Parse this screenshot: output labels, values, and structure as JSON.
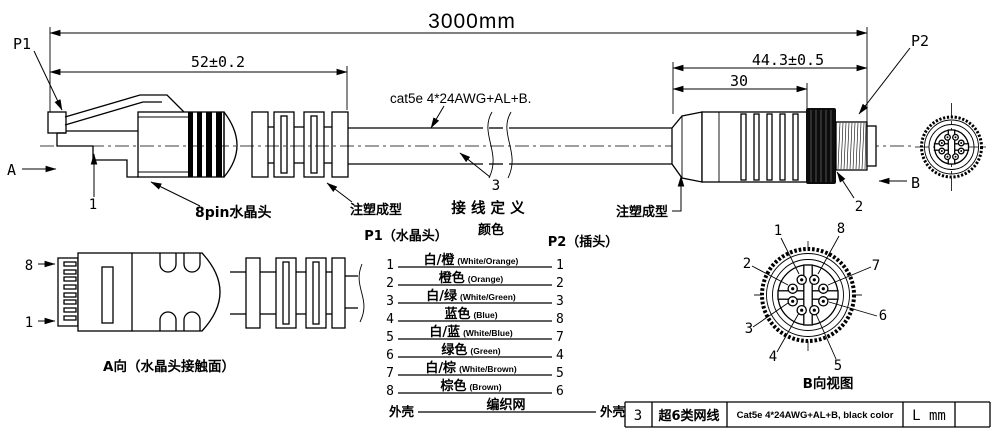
{
  "drawing": {
    "dims": {
      "overall": "3000mm",
      "len52": "52±0.2",
      "len443": "44.3±0.5",
      "len30": "30"
    },
    "ports": {
      "p1": "P1",
      "p2": "P2"
    },
    "views": {
      "a_arrow": "A",
      "b_arrow": "B"
    },
    "callouts": {
      "n1": "1",
      "n2": "2",
      "n3": "3",
      "rj45_label": "8pin水晶头",
      "mold_left": "注塑成型",
      "mold_right": "注塑成型",
      "cable_spec": "cat5e 4*24AWG+AL+B."
    },
    "wiring": {
      "title": "接 线 定 义",
      "col_p1": "P1（水晶头）",
      "col_color": "颜色",
      "col_p2": "P2（插头）",
      "rows": [
        {
          "p1": "1",
          "color": "白/橙",
          "color_en": "(White/Orange)",
          "p2": "1"
        },
        {
          "p1": "2",
          "color": "橙色",
          "color_en": "(Orange)",
          "p2": "2"
        },
        {
          "p1": "3",
          "color": "白/绿",
          "color_en": "(White/Green)",
          "p2": "3"
        },
        {
          "p1": "4",
          "color": "蓝色",
          "color_en": "(Blue)",
          "p2": "8"
        },
        {
          "p1": "5",
          "color": "白/蓝",
          "color_en": "(White/Blue)",
          "p2": "7"
        },
        {
          "p1": "6",
          "color": "绿色",
          "color_en": "(Green)",
          "p2": "4"
        },
        {
          "p1": "7",
          "color": "白/棕",
          "color_en": "(White/Brown)",
          "p2": "5"
        },
        {
          "p1": "8",
          "color": "棕色",
          "color_en": "(Brown)",
          "p2": "6"
        },
        {
          "p1": "外壳",
          "color": "编织网",
          "color_en": "",
          "p2": "外壳"
        }
      ]
    },
    "a_view": {
      "caption": "A向（水晶头接触面）",
      "pin8": "8",
      "pin1": "1"
    },
    "b_view": {
      "caption": "B向视图",
      "pins": {
        "n1": "1",
        "n2": "2",
        "n3": "3",
        "n4": "4",
        "n5": "5",
        "n6": "6",
        "n7": "7",
        "n8": "8"
      }
    },
    "bom": {
      "no": "3",
      "name": "超6类网线",
      "spec": "Cat5e  4*24AWG+AL+B, black color",
      "length": "L mm",
      "remark": ""
    }
  }
}
